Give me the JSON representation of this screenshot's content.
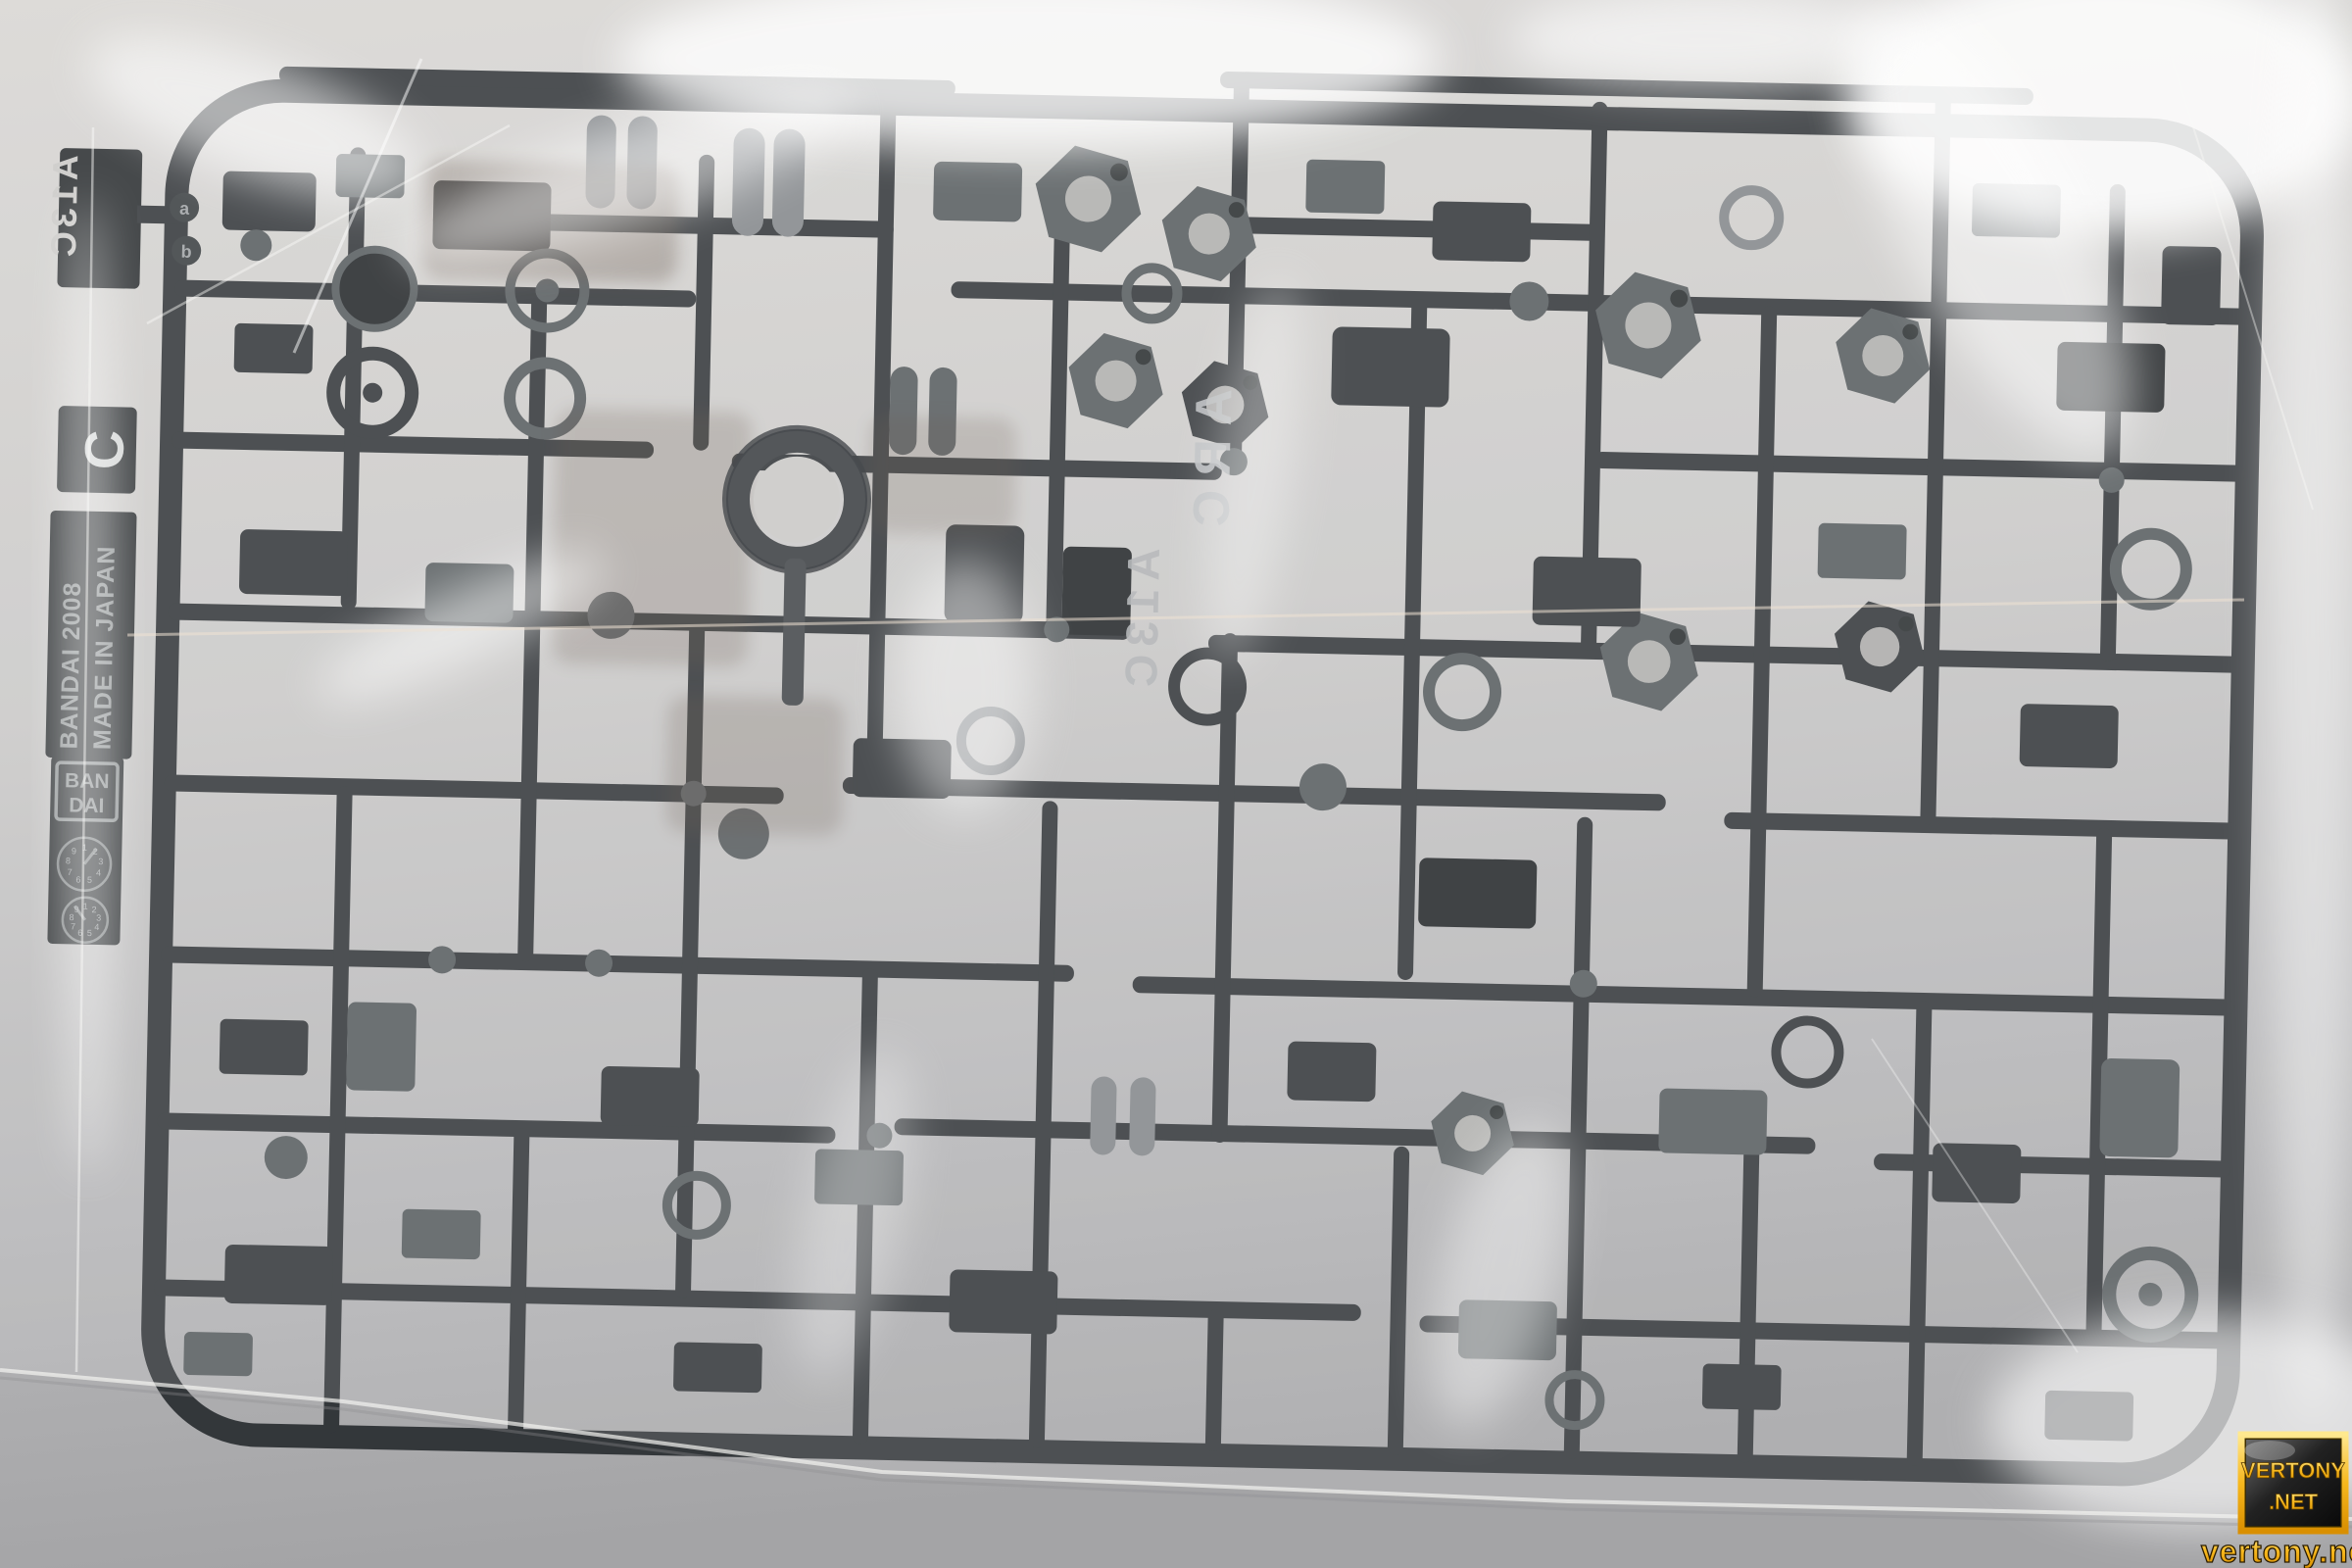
{
  "sprue": {
    "maker_text_line1": "BANDAI 2008",
    "maker_text_line2": "MADE IN JAPAN",
    "logo_line1": "BAN",
    "logo_line2": "DAI",
    "runner_letter": "C",
    "runner_tag_front": "A13C",
    "runner_tag_back_line1": "ARC",
    "runner_tag_back_line2": "A13C",
    "part_marker_a": "a",
    "part_marker_b": "b",
    "date_wheel_digits": "123456789"
  },
  "watermark": {
    "badge_line1": "VERTONY",
    "badge_line2": ".NET",
    "url": "vertony.net"
  },
  "colors": {
    "background_top": "#d8d6d3",
    "background_mid": "#c6c5c4",
    "background_bottom": "#a4a4a6",
    "bag_highlight": "#ffffff",
    "bag_tint": "#f4f3f1",
    "plastic_dark": "#33373a",
    "plastic_darker": "#24282a",
    "plastic_mid": "#575c5f",
    "plastic_light": "#83878a",
    "plastic_brown": "#5a4a3c",
    "tag_plate": "#2b2f31",
    "tag_text": "#c9c8c6",
    "emboss_text": "#8e9294",
    "gold": "#f2ae00",
    "gold_light": "#ffdf6e",
    "gold_outline": "#5a3c00",
    "badge_bg_dark": "#101010"
  }
}
